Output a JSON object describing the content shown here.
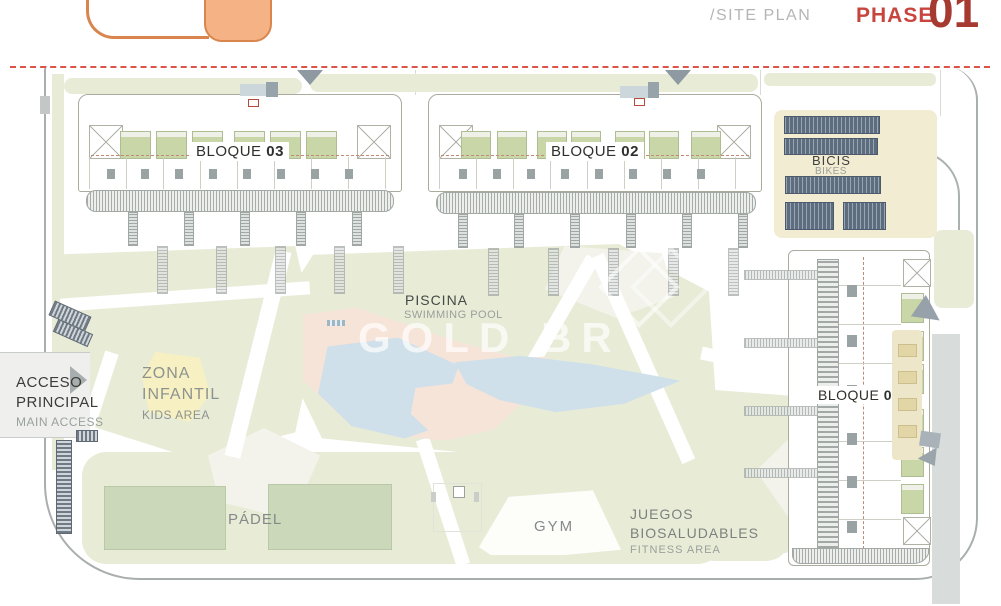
{
  "header": {
    "site_plan_label": "/SITE PLAN",
    "phase_label": "PHASE",
    "phase_number": "01"
  },
  "labels": {
    "bloque03": {
      "name": "BLOQUE",
      "number": "03"
    },
    "bloque02": {
      "name": "BLOQUE",
      "number": "02"
    },
    "bloque01": {
      "name": "BLOQUE",
      "number": "01"
    },
    "bicis": {
      "primary": "BICIS",
      "secondary": "BIKES"
    },
    "piscina": {
      "primary": "PISCINA",
      "secondary": "SWIMMING POOL"
    },
    "zona_infantil": {
      "line1": "ZONA",
      "line2": "INFANTIL",
      "secondary": "KIDS AREA"
    },
    "acceso": {
      "line1": "ACCESO",
      "line2": "PRINCIPAL",
      "secondary": "MAIN ACCESS"
    },
    "padel": {
      "primary": "PÁDEL"
    },
    "gym": {
      "primary": "GYM"
    },
    "juegos": {
      "line1": "JUEGOS",
      "line2": "BIOSALUDABLES",
      "secondary": "FITNESS AREA"
    }
  },
  "watermark": {
    "text": "GOLD BR"
  },
  "colors": {
    "accent_orange": "#f5b285",
    "phase_red": "#c8453e",
    "phase_number_red": "#a63a31",
    "boundary_red": "#dd5348",
    "lawn_green": "#e8ecd7",
    "roof_green": "#c9d7a8",
    "court_green": "#cbd9ba",
    "deck_salmon": "#f7e4d8",
    "pool_blue": "#cfe0ea",
    "bike_rack_navy": "#5d6d80",
    "path_beige": "#f2ecd2",
    "road_gray": "#a9aeae"
  }
}
